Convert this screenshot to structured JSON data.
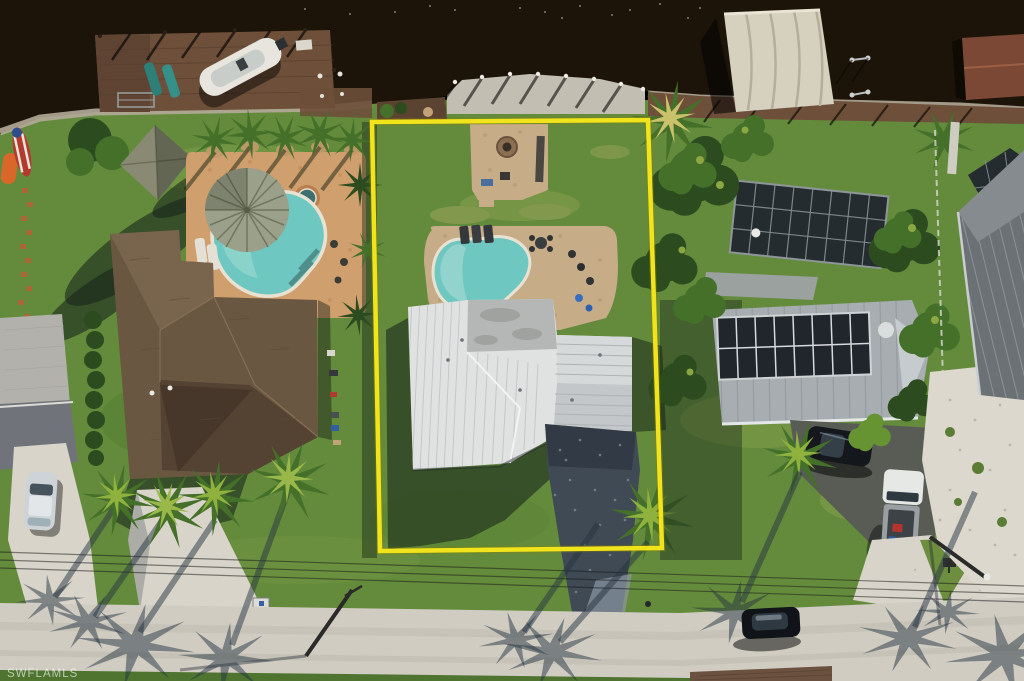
{
  "watermark": {
    "text": "SWFLAMLS"
  },
  "scene": {
    "type": "aerial-drone-photo",
    "subject": "waterfront residential lot outlined with yellow property boundary",
    "elements": [
      "canal-water",
      "docks",
      "boat-on-lift",
      "canvas-boat-canopy",
      "left-house-brown-shingle-roof",
      "left-pool-with-tiki-umbrella",
      "center-house-white-metal-roof",
      "center-pool",
      "paver-patio-firepit",
      "pebble-driveway",
      "right-house-solar-panel-roof",
      "screen-enclosure",
      "black-suv",
      "white-pickup-truck",
      "parked-black-car",
      "street",
      "palm-trees",
      "long-palm-shadows",
      "power-lines",
      "utility-poles"
    ]
  },
  "palette": {
    "water": "#1d1409",
    "seawall": "#b2a898",
    "dockWood": "#6d4f3a",
    "boatWhite": "#e7e5de",
    "canopy": "#d6d0bf",
    "lawn": "#648b3c",
    "lawnLight": "#8aa852",
    "deckLeft": "#cf9f6d",
    "deckCenter": "#c7ad87",
    "pool": "#6fc7c1",
    "poolShallow": "#a5dcd4",
    "coping": "#e9e2d2",
    "roofBrown": "#6a5742",
    "roofBrownDark": "#544232",
    "roofWhite": "#e0e2e2",
    "roofFlatGray": "#b5b7b7",
    "roofMetal": "#a7adb1",
    "solar": "#20262c",
    "screen": "#242c2f",
    "rightRoof": "#6b7175",
    "shell": "#dcd8cd",
    "road": "#d0ccc2",
    "concrete": "#d8d4c9",
    "pebble": "#3f4a55",
    "paverBrown": "#6b5240",
    "treeDark": "#2c4c1f",
    "treeMid": "#44702a",
    "treeLight": "#679433",
    "shadow": "rgba(20,32,26,0.55)",
    "roadShadow": "rgba(38,52,66,0.5)",
    "boundary": "#f2e41c",
    "watermark": "rgba(255,255,255,0.62)"
  }
}
